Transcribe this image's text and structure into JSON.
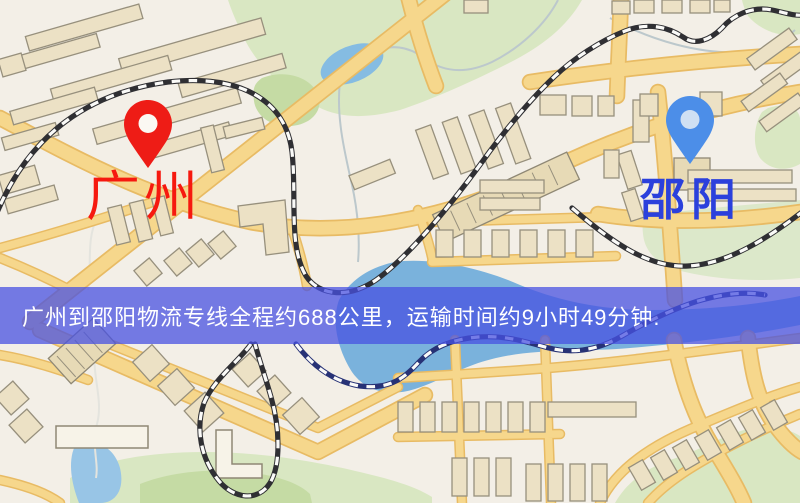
{
  "page": {
    "width": 800,
    "height": 503,
    "type": "logistics-route-map"
  },
  "banner": {
    "text": "广州到邵阳物流专线全程约688公里，运输时间约9小时49分钟.",
    "background": "rgba(72,82,226,0.75)",
    "text_color": "#ffffff"
  },
  "route": {
    "origin": "广州",
    "destination": "邵阳",
    "distance_text": "约688公里",
    "duration_text": "约9小时49分钟"
  },
  "markers": {
    "origin": {
      "label": "广州",
      "label_color": "#f6190f",
      "pin_color": "#ee1c16",
      "pin_hole_color": "#fbf8f3",
      "icon": "map-pin-icon"
    },
    "destination": {
      "label": "邵阳",
      "label_color": "#2b40dc",
      "pin_color": "#4c8ee8",
      "pin_hole_color": "#cfe0f3",
      "icon": "map-pin-icon"
    }
  },
  "map_palette": {
    "background": "#f3efe7",
    "road_fill": "#f6d78c",
    "road_casing": "#e8bb64",
    "railway": "#2f2f33",
    "water": "#7ab2dc",
    "park": "#d9e7c2",
    "building": "#ece1c5"
  }
}
